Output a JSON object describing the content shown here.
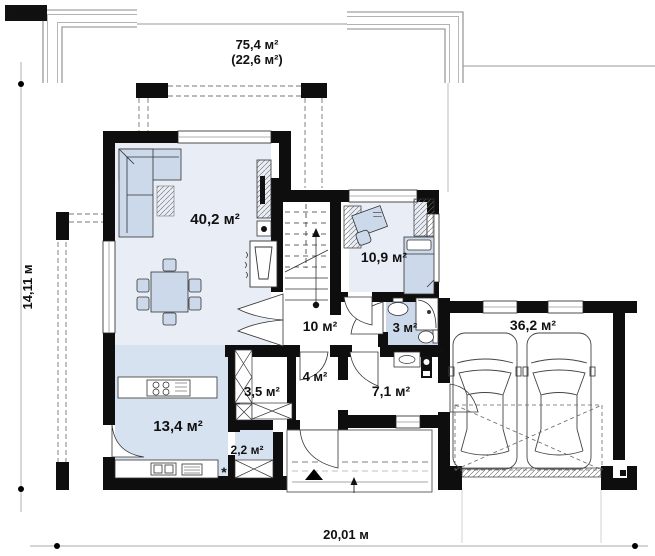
{
  "logo": "Z500©",
  "header": {
    "area_total": "75,4 м²",
    "area_secondary": "(22,6 м²)"
  },
  "dimensions": {
    "width": "20,01 м",
    "height": "14,11 м"
  },
  "rooms": {
    "living": "40,2 м²",
    "bedroom": "10,9 м²",
    "hall": "10 м²",
    "bathroom": "3 м²",
    "wardrobe": "3,5 м²",
    "vestibule": "4 м²",
    "utility": "7,1 м²",
    "kitchen": "13,4 м²",
    "pantry": "2,2 м²",
    "garage": "36,2 м²"
  },
  "symbols": {
    "kitchen_star": "*"
  },
  "colors": {
    "wall": "#0e0e0e",
    "floor_light": "#e9eef6",
    "floor_mid": "#d7e2f0",
    "floor_bath": "#ccd9ea",
    "furniture": "#cbd9ea"
  }
}
